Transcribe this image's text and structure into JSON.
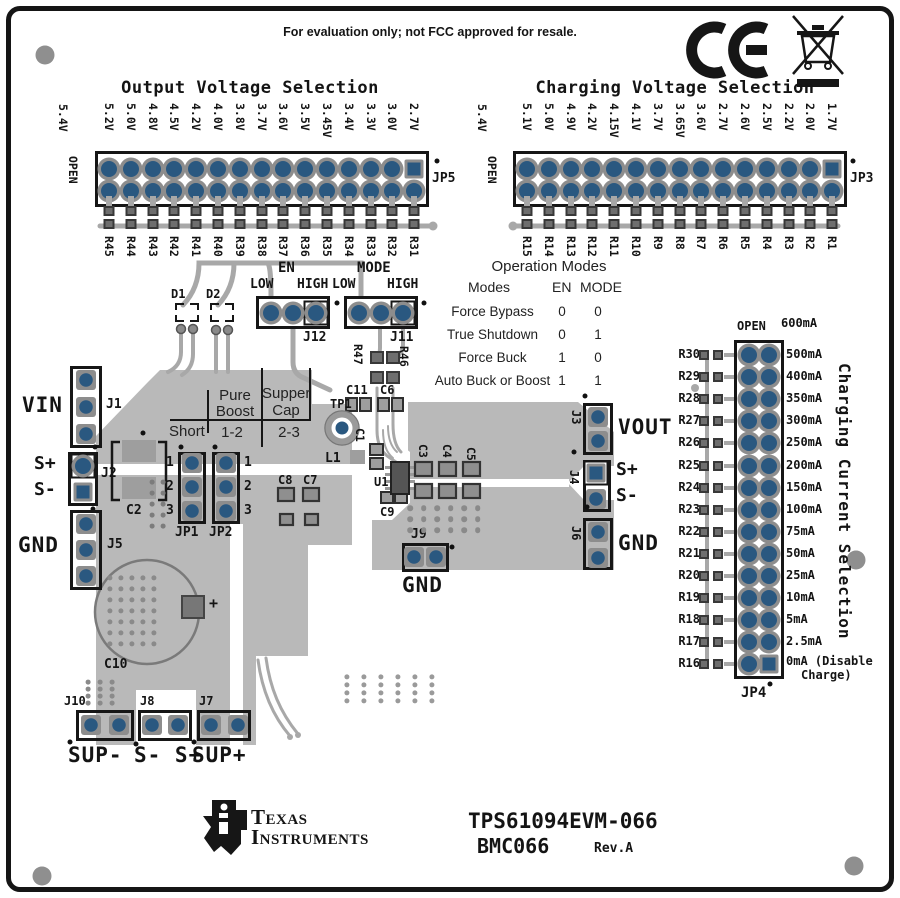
{
  "board": {
    "evaluation_notice": "For evaluation only; not FCC approved for resale.",
    "part_number": "TPS61094EVM-066",
    "board_code": "BMC066",
    "revision": "Rev.A",
    "manufacturer": {
      "name_line1": "Texas",
      "name_line2": "Instruments"
    }
  },
  "icons": {
    "ce": "ce-mark",
    "weee": "weee-crossed-bin-icon",
    "ti": "ti-logo"
  },
  "output_voltage": {
    "title": "Output Voltage Selection",
    "open_label": "OPEN",
    "open_option": "5.4V",
    "connector": "JP5",
    "options": [
      "5.2V",
      "5.0V",
      "4.8V",
      "4.5V",
      "4.2V",
      "4.0V",
      "3.8V",
      "3.7V",
      "3.6V",
      "3.5V",
      "3.45V",
      "3.4V",
      "3.3V",
      "3.0V",
      "2.7V"
    ],
    "resistors": [
      "R45",
      "R44",
      "R43",
      "R42",
      "R41",
      "R40",
      "R39",
      "R38",
      "R37",
      "R36",
      "R35",
      "R34",
      "R33",
      "R32",
      "R31"
    ]
  },
  "charging_voltage": {
    "title": "Charging Voltage Selection",
    "open_label": "OPEN",
    "open_option": "5.4V",
    "connector": "JP3",
    "options": [
      "5.1V",
      "5.0V",
      "4.9V",
      "4.2V",
      "4.15V",
      "4.1V",
      "3.7V",
      "3.65V",
      "3.6V",
      "2.7V",
      "2.6V",
      "2.5V",
      "2.2V",
      "2.0V",
      "1.7V"
    ],
    "resistors": [
      "R15",
      "R14",
      "R13",
      "R12",
      "R11",
      "R10",
      "R9",
      "R8",
      "R7",
      "R6",
      "R5",
      "R4",
      "R3",
      "R2",
      "R1"
    ]
  },
  "operation_modes": {
    "title": "Operation Modes",
    "headers": {
      "modes": "Modes",
      "en": "EN",
      "mode": "MODE"
    },
    "rows": [
      [
        "Force Bypass",
        "0",
        "0"
      ],
      [
        "True Shutdown",
        "0",
        "1"
      ],
      [
        "Force Buck",
        "1",
        "0"
      ],
      [
        "Au​to Buck or Boost",
        "1",
        "1"
      ]
    ]
  },
  "control_jumpers": {
    "en": {
      "signal": "EN",
      "low": "LOW",
      "high": "HIGH",
      "ref": "J12"
    },
    "mode": {
      "signal": "MODE",
      "low": "LOW",
      "high": "HIGH",
      "ref": "J11"
    },
    "d1": "D1",
    "d2": "D2",
    "r47": "R47",
    "r46": "R46"
  },
  "boost_mode_table": {
    "col_pure_1": "Pure",
    "col_pure_2": "Boost",
    "col_cap_1": "Supper",
    "col_cap_2": "Cap",
    "row_short": "Short",
    "row_pure": "1-2",
    "row_cap": "2-3",
    "jp1": "JP1",
    "jp2": "JP2",
    "pins": [
      "1",
      "2",
      "3"
    ]
  },
  "charging_current": {
    "title": "Charging Current Selection",
    "open_label": "OPEN",
    "open_option": "600mA",
    "connector": "JP4",
    "rows": [
      {
        "resistor": "R30",
        "current": "500mA"
      },
      {
        "resistor": "R29",
        "current": "400mA"
      },
      {
        "resistor": "R28",
        "current": "350mA"
      },
      {
        "resistor": "R27",
        "current": "300mA"
      },
      {
        "resistor": "R26",
        "current": "250mA"
      },
      {
        "resistor": "R25",
        "current": "200mA"
      },
      {
        "resistor": "R24",
        "current": "150mA"
      },
      {
        "resistor": "R23",
        "current": "100mA"
      },
      {
        "resistor": "R22",
        "current": "75mA"
      },
      {
        "resistor": "R21",
        "current": "50mA"
      },
      {
        "resistor": "R20",
        "current": "25mA"
      },
      {
        "resistor": "R19",
        "current": "10mA"
      },
      {
        "resistor": "R18",
        "current": "5mA"
      },
      {
        "resistor": "R17",
        "current": "2.5mA"
      },
      {
        "resistor": "R16",
        "current": "0mA (Disable",
        "current2": "Charge)"
      }
    ]
  },
  "connectors": {
    "j1": {
      "ref": "J1",
      "label": "VIN"
    },
    "j2": {
      "ref": "J2",
      "pos": "S+",
      "neg": "S-"
    },
    "j5": {
      "ref": "J5",
      "label": "GND"
    },
    "j3": {
      "ref": "J3",
      "label": "VOUT"
    },
    "j4": {
      "ref": "J4",
      "pos": "S+",
      "neg": "S-"
    },
    "j6": {
      "ref": "J6",
      "label": "GND"
    },
    "j9": {
      "ref": "J9",
      "label": "GND"
    },
    "j10": {
      "ref": "J10",
      "label": "SUP-"
    },
    "j8": {
      "ref": "J8",
      "label": "S- S+"
    },
    "j7": {
      "ref": "J7",
      "label": "SUP+"
    }
  },
  "components": {
    "tp1": "TP1",
    "l1": "L1",
    "u1": "U1",
    "c1": "C1",
    "c2": "C2",
    "c3": "C3",
    "c4": "C4",
    "c5": "C5",
    "c6": "C6",
    "c7": "C7",
    "c8": "C8",
    "c9": "C9",
    "c10": "C10",
    "c11": "C11",
    "plus": "+"
  }
}
